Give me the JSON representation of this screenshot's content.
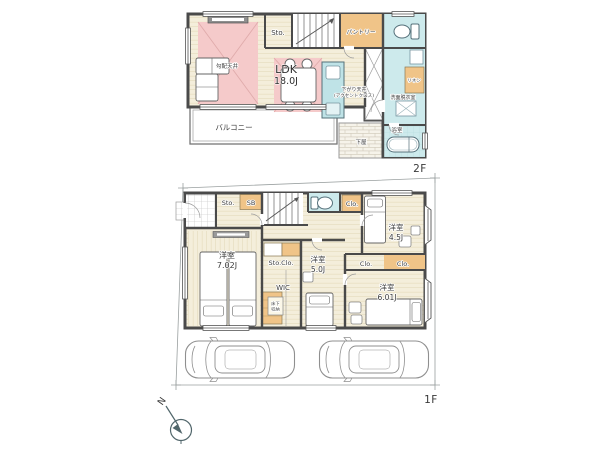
{
  "colors": {
    "wall": "#4a4a4a",
    "floor_cream": "#f4eedb",
    "accent_pink": "#f5caca",
    "accent_orange": "#f0c488",
    "accent_blue": "#cdeaec",
    "boundary_gray": "#9aa0a0",
    "compass_blue": "#51666b"
  },
  "floor2": {
    "floor_label": "2F",
    "ldk": {
      "name": "LDK",
      "size": "18.0J"
    },
    "sloped_ceiling": "勾配天井",
    "storage": "Sto.",
    "pantry": "パントリー",
    "lowered_ceiling": "下がり天井",
    "lowered_ceiling_note": "(アクセントクロス)",
    "linen": "リネン",
    "washroom": "洗面脱衣室",
    "bathroom": "浴室",
    "balcony": "バルコニー",
    "lower_roof": "下屋"
  },
  "floor1": {
    "floor_label": "1F",
    "storage": "Sto.",
    "shoe_box": "SB",
    "closet_top": "Clo.",
    "room_45": {
      "name": "洋室",
      "size": "4.5J"
    },
    "room_70": {
      "name": "洋室",
      "size": "7.02J"
    },
    "storage_closet": "Sto.Clo.",
    "wic": "WIC",
    "underfloor_storage_1": "床下",
    "underfloor_storage_2": "収納",
    "room_50": {
      "name": "洋室",
      "size": "5.0J"
    },
    "closet_a": "Clo.",
    "closet_b": "Clo.",
    "room_60": {
      "name": "洋室",
      "size": "6.01J"
    }
  },
  "compass": {
    "north": "N"
  }
}
